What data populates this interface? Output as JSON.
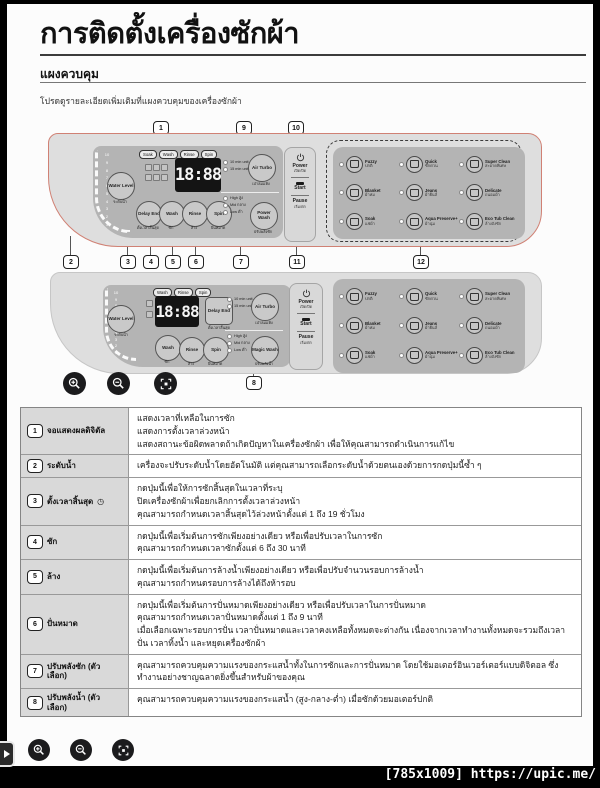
{
  "header": {
    "title": "การติดตั้งเครื่องซักผ้า",
    "section": "แผงควบคุม",
    "intro": "โปรดดูรายละเอียดเพิ่มเติมที่แผงควบคุมของเครื่องซักผ้า"
  },
  "callouts": [
    "1",
    "2",
    "3",
    "4",
    "5",
    "6",
    "7",
    "8",
    "9",
    "10",
    "11",
    "12"
  ],
  "water_scale": [
    "10",
    "9",
    "8",
    "7",
    "6",
    "5",
    "4",
    "3",
    "2",
    "1"
  ],
  "panel1": {
    "pills": [
      "Soak",
      "Wash",
      "Rinse",
      "Spin"
    ],
    "display": "18:88",
    "water_level": {
      "label": "Water Level",
      "sub": "ระดับน้ำ"
    },
    "buttons": [
      {
        "label": "Delay End",
        "sub": "ตั้งเวลาสิ้นสุด"
      },
      {
        "label": "Wash",
        "sub": "ซัก"
      },
      {
        "label": "Rinse",
        "sub": "ล้าง"
      },
      {
        "label": "Spin",
        "sub": "ปั่นหมาด"
      }
    ],
    "air_turbo": {
      "label": "Air Turbo",
      "sub": "เป่าลมแห้ง",
      "leds": [
        "10 min unit",
        "15 min unit"
      ]
    },
    "power_wash": {
      "label": "Power Wash",
      "sub": "ปรับพลังซัก",
      "leds": [
        "High สูง",
        "Mid กลาง",
        "Low ต่ำ"
      ]
    },
    "power": {
      "label": "Power",
      "sub": "เปิด/ปิด",
      "start": "Start",
      "pause": "Pause",
      "start_sub": "เริ่ม/พัก"
    }
  },
  "panel2": {
    "pills": [
      "Wash",
      "Rinse",
      "Spin"
    ],
    "display": "18:88",
    "water_level": {
      "label": "Water Level",
      "sub": "ระดับน้ำ"
    },
    "delay_end": {
      "label": "Delay End",
      "sub": "ตั้งเวลาสิ้นสุด"
    },
    "buttons": [
      {
        "label": "Wash",
        "sub": "ซัก"
      },
      {
        "label": "Rinse",
        "sub": "ล้าง"
      },
      {
        "label": "Spin",
        "sub": "ปั่นหมาด"
      }
    ],
    "air_turbo": {
      "label": "Air Turbo",
      "sub": "เป่าลมแห้ง",
      "leds": [
        "10 min unit",
        "15 min unit"
      ]
    },
    "magic_wash": {
      "label": "Magic Wash",
      "sub": "ปรับพลังน้ำ",
      "leds": [
        "High สูง",
        "Mid กลาง",
        "Low ต่ำ"
      ]
    },
    "power": {
      "label": "Power",
      "sub": "เปิด/ปิด",
      "start": "Start",
      "pause": "Pause",
      "start_sub": "เริ่ม/พัก"
    }
  },
  "programs": [
    {
      "label": "Fuzzy",
      "sub": "ปกติ"
    },
    {
      "label": "Quick",
      "sub": "ซักด่วน"
    },
    {
      "label": "Super Clean",
      "sub": "สะอาดพิเศษ"
    },
    {
      "label": "Blanket",
      "sub": "ผ้าห่ม"
    },
    {
      "label": "Jeans",
      "sub": "ผ้ายีนส์"
    },
    {
      "label": "Delicate",
      "sub": "ถนอมผ้า"
    },
    {
      "label": "Soak",
      "sub": "แช่ผ้า"
    },
    {
      "label": "Aqua Preserve+",
      "sub": "ผ้านุ่ม"
    },
    {
      "label": "Eco Tub Clean",
      "sub": "ล้างถังซัก"
    }
  ],
  "table": {
    "rows": [
      {
        "num": "1",
        "label": "จอแสดงผลดิจิตัล",
        "suffix": "",
        "desc": "แสดงเวลาที่เหลือในการซัก\nแสดงการตั้งเวลาล่วงหน้า\nแสดงสถานะข้อผิดพลาดถ้าเกิดปัญหาในเครื่องซักผ้า เพื่อให้คุณสามารถดำเนินการแก้ไข"
      },
      {
        "num": "2",
        "label": "ระดับน้ำ",
        "suffix": "",
        "desc": "เครื่องจะปรับระดับน้ำโดยอัตโนมัติ แต่คุณสามารถเลือกระดับน้ำด้วยตนเองด้วยการกดปุ่มนี้ซ้ำ ๆ"
      },
      {
        "num": "3",
        "label": "ตั้งเวลาสิ้นสุด",
        "suffix": "◷",
        "desc": "กดปุ่มนี้เพื่อให้การซักสิ้นสุดในเวลาที่ระบุ\nปิดเครื่องซักผ้าเพื่อยกเลิกการตั้งเวลาล่วงหน้า\nคุณสามารถกำหนดเวลาสิ้นสุดไว้ล่วงหน้าตั้งแต่ 1 ถึง 19 ชั่วโมง"
      },
      {
        "num": "4",
        "label": "ซัก",
        "suffix": "",
        "desc": "กดปุ่มนี้เพื่อเริ่มต้นการซักเพียงอย่างเดียว หรือเพื่อปรับเวลาในการซัก\nคุณสามารถกำหนดเวลาซักตั้งแต่ 6 ถึง 30 นาที"
      },
      {
        "num": "5",
        "label": "ล้าง",
        "suffix": "",
        "desc": "กดปุ่มนี้เพื่อเริ่มต้นการล้างน้ำเพียงอย่างเดียว หรือเพื่อปรับจำนวนรอบการล้างน้ำ\nคุณสามารถกำหนดรอบการล้างได้ถึงห้ารอบ"
      },
      {
        "num": "6",
        "label": "ปั่นหมาด",
        "suffix": "",
        "desc": "กดปุ่มนี้เพื่อเริ่มต้นการปั่นหมาดเพียงอย่างเดียว หรือเพื่อปรับเวลาในการปั่นหมาด\nคุณสามารถกำหนดเวลาปั่นหมาดตั้งแต่ 1 ถึง 9 นาที\nเมื่อเลือกเฉพาะรอบการปั่น เวลาปั่นหมาดและเวลาคงเหลือทั้งหมดจะต่างกัน เนื่องจากเวลาทำงานทั้งหมดจะรวมถึงเวลาปั่น เวลาทิ้งน้ำ และหยุดเครื่องซักผ้า"
      },
      {
        "num": "7",
        "label": "ปรับพลังซัก (ตัวเลือก)",
        "suffix": "",
        "desc": "คุณสามารถควบคุมความแรงของกระแสน้ำทั้งในการซักและการปั่นหมาด โดยใช้มอเตอร์อินเวอร์เตอร์แบบดิจิตอล ซึ่งทำงานอย่างชาญฉลาดยิ่งขึ้นสำหรับผ้าของคุณ"
      },
      {
        "num": "8",
        "label": "ปรับพลังน้ำ (ตัวเลือก)",
        "suffix": "",
        "desc": "คุณสามารถควบคุมความแรงของกระแสน้ำ (สูง-กลาง-ต่ำ) เมื่อซักด้วยมอเตอร์ปกติ"
      }
    ]
  },
  "viewer": {
    "watermark": "[785x1009] https://upic.me/"
  }
}
